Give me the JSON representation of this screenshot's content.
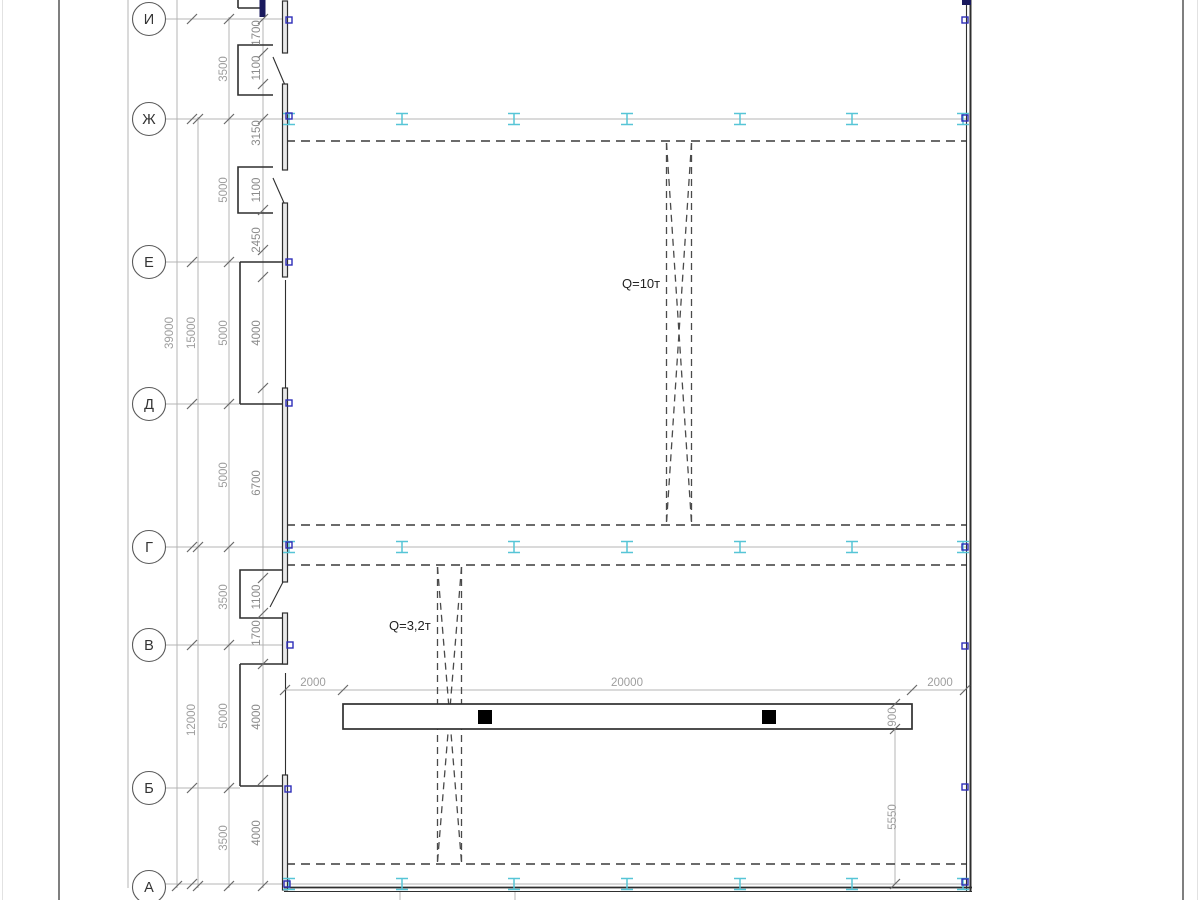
{
  "drawing": {
    "title": "workshop-floor-plan-fragment",
    "axes": [
      "И",
      "Ж",
      "Е",
      "Д",
      "Г",
      "В",
      "Б",
      "А"
    ],
    "inner_dims": [
      "1700",
      "1100",
      "3150",
      "1100",
      "2450",
      "4000",
      "6700",
      "1100",
      "1700",
      "4000",
      "4000"
    ],
    "spacing_dims": [
      "3500",
      "5000",
      "5000",
      "5000",
      "3500",
      "5000",
      "3500"
    ],
    "total_dims": [
      "39000",
      "15000",
      "12000"
    ],
    "beam_dims": [
      "2000",
      "20000",
      "2000"
    ],
    "beam_side_dims": [
      "900",
      "5550"
    ],
    "cranes": [
      {
        "label": "Q=10т"
      },
      {
        "label": "Q=3,2т"
      }
    ],
    "colors": {
      "line_dark": "#2f2f2f",
      "dim_gray": "#9e9e9e",
      "ibeam_marker_cyan": "#56c5d6",
      "column_marker_blue": "#2d2db8"
    }
  }
}
